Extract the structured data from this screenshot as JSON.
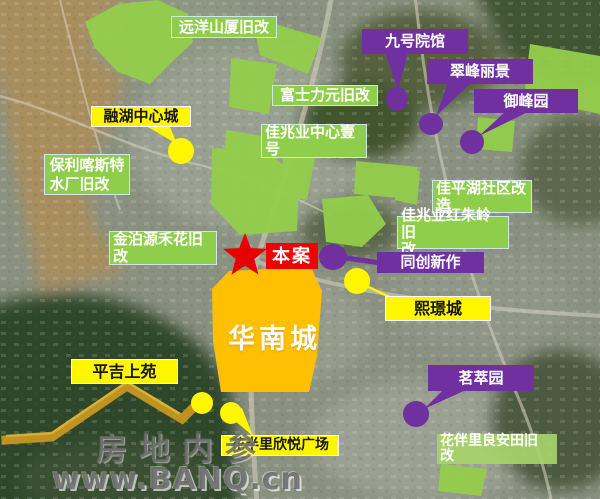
{
  "map": {
    "site_marker": {
      "label": "本案"
    },
    "main_zone": {
      "label": "华南城"
    },
    "green_labels": [
      {
        "id": "yuanyang",
        "text": "远洋山厦旧改"
      },
      {
        "id": "fushiliyuan",
        "text": "富士力元旧改"
      },
      {
        "id": "jiazhaoye-center",
        "text": "佳兆业中心壹\n号"
      },
      {
        "id": "baoli-kasite",
        "text": "保利喀斯特\n水厂旧改"
      },
      {
        "id": "jinboyuan-hehua",
        "text": "金泊源禾花旧\n改"
      },
      {
        "id": "jiapinghu-shequ",
        "text": "佳平湖社区改\n造"
      },
      {
        "id": "jiazhaoye-hongzhuling",
        "text": "佳兆业红朱岭旧\n改"
      },
      {
        "id": "huabanli-liangantian",
        "text": "花伴里良安田旧\n改"
      }
    ],
    "yellow_labels": [
      {
        "id": "ronghu-zhongxincheng",
        "text": "融湖中心城"
      },
      {
        "id": "pingji-shangyuan",
        "text": "平吉上苑"
      },
      {
        "id": "xijingcheng",
        "text": "熙璟城"
      },
      {
        "id": "huabanli-xinyue",
        "text": "花半里欣悦广场"
      }
    ],
    "purple_labels": [
      {
        "id": "jiuhao-yuanguan",
        "text": "九号院馆"
      },
      {
        "id": "cuifeng-lijing",
        "text": "翠峰丽景"
      },
      {
        "id": "yufengyuan",
        "text": "御峰园"
      },
      {
        "id": "tongchuang-xinzuo",
        "text": "同创新作"
      },
      {
        "id": "mingcuiyuan",
        "text": "茗萃园"
      }
    ]
  },
  "colors": {
    "zone_green": "#8FCE4B",
    "label_yellow": "#FFF600",
    "label_purple": "#7030A0",
    "zone_orange": "#FFC000",
    "site_red": "#EE0202",
    "pointer_gold": "#BE9320"
  },
  "watermark": {
    "line1": "房地内参",
    "line2": "www.BANQ.cn"
  }
}
